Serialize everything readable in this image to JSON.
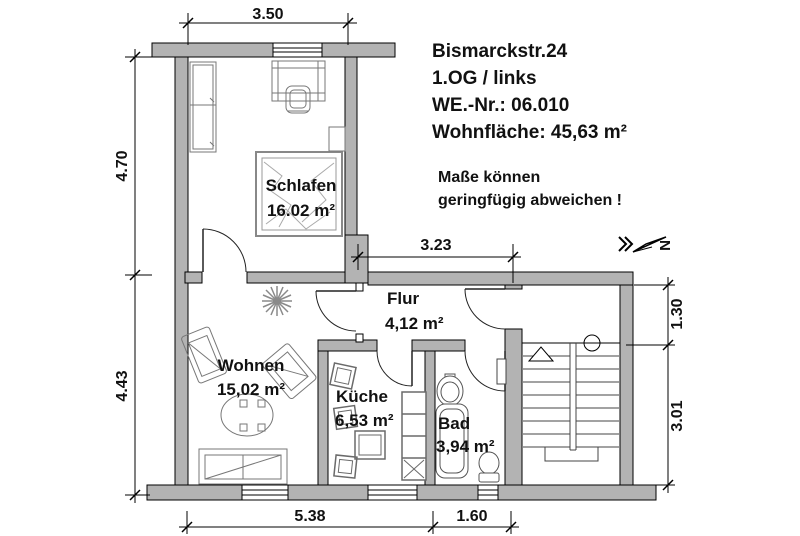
{
  "title_block": {
    "address": "Bismarckstr.24",
    "floor": "1.OG / links",
    "unit_number": "WE.-Nr.: 06.010",
    "living_area": "Wohnfläche: 45,63 m²",
    "note_line1": "Maße können",
    "note_line2": "geringfügig abweichen !"
  },
  "rooms": [
    {
      "name": "Schlafen",
      "area": "16.02 m²"
    },
    {
      "name": "Wohnen",
      "area": "15,02 m²"
    },
    {
      "name": "Flur",
      "area": "4,12 m²"
    },
    {
      "name": "Küche",
      "area": "6,53 m²"
    },
    {
      "name": "Bad",
      "area": "3,94 m²"
    }
  ],
  "dimensions": {
    "top_width": "3.50",
    "left_upper": "4.70",
    "left_lower": "4.43",
    "middle_width": "3.23",
    "right_upper": "1.30",
    "right_lower": "3.01",
    "bottom_left": "5.38",
    "bottom_right": "1.60"
  },
  "north_arrow": {
    "label": "N"
  },
  "colors": {
    "wall_fill": "#b3b3b3",
    "line_color": "#000000",
    "background": "#ffffff"
  }
}
